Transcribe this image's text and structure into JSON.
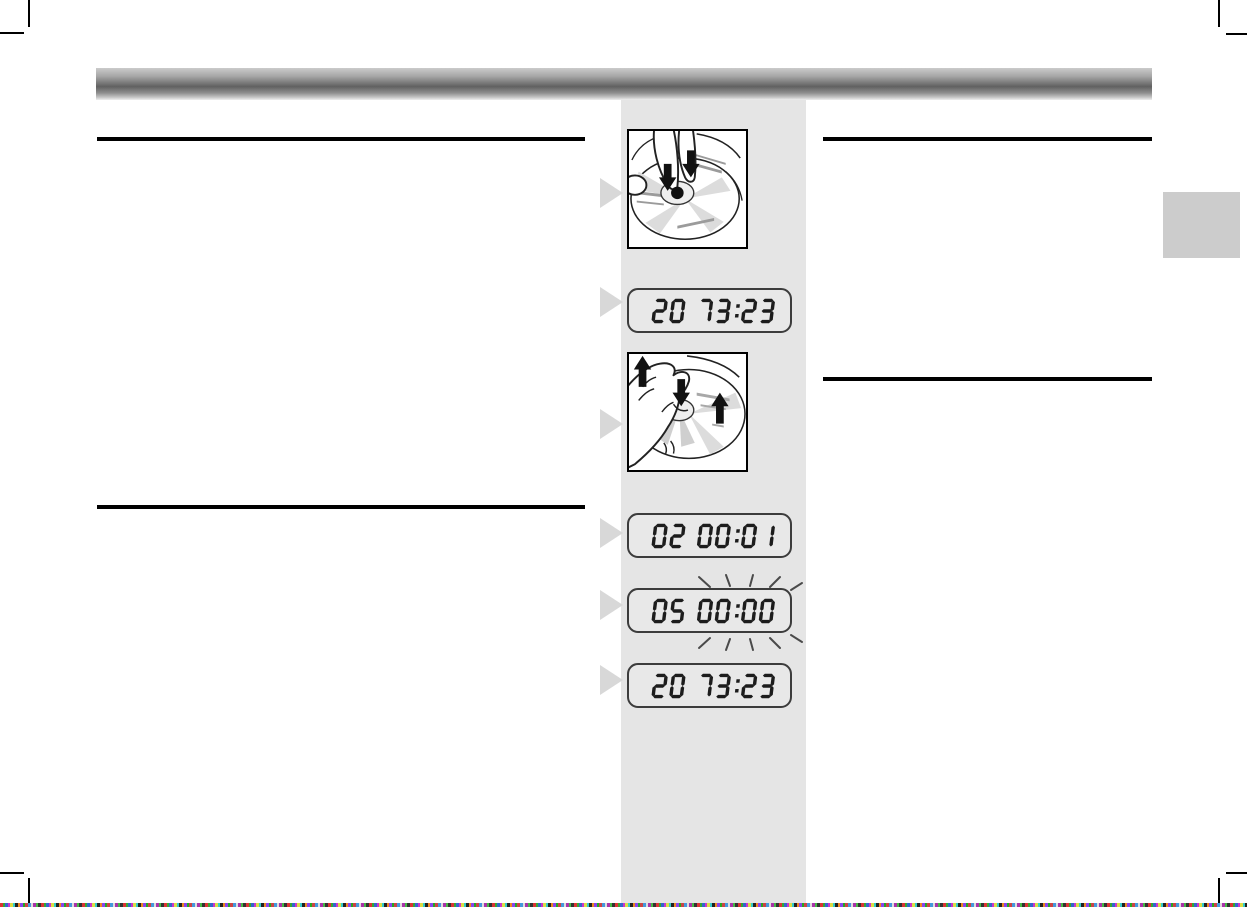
{
  "page": {
    "kind": "scanned-manual-page"
  },
  "colors": {
    "column_bg": "#e5e5e5",
    "edge_tab": "#cccccc",
    "step_marker": "#d8d8d8",
    "rule": "#000000",
    "lcd_digit": "#1c1c1c",
    "blink_ray": "#4a4a4a"
  },
  "lcd_displays": [
    {
      "id": "lcd-1",
      "value": "20 73:23",
      "blink": false
    },
    {
      "id": "lcd-2",
      "value": "02 00:01",
      "blink": false
    },
    {
      "id": "lcd-3",
      "value": "05 00:00",
      "blink": true
    },
    {
      "id": "lcd-4",
      "value": "20 73:23",
      "blink": false
    }
  ],
  "illustrations": [
    {
      "id": "illus-1",
      "name": "insert-disc-illustration"
    },
    {
      "id": "illus-2",
      "name": "remove-disc-illustration"
    }
  ],
  "step_markers": {
    "count": 6,
    "icon": "right-triangle-icon"
  }
}
